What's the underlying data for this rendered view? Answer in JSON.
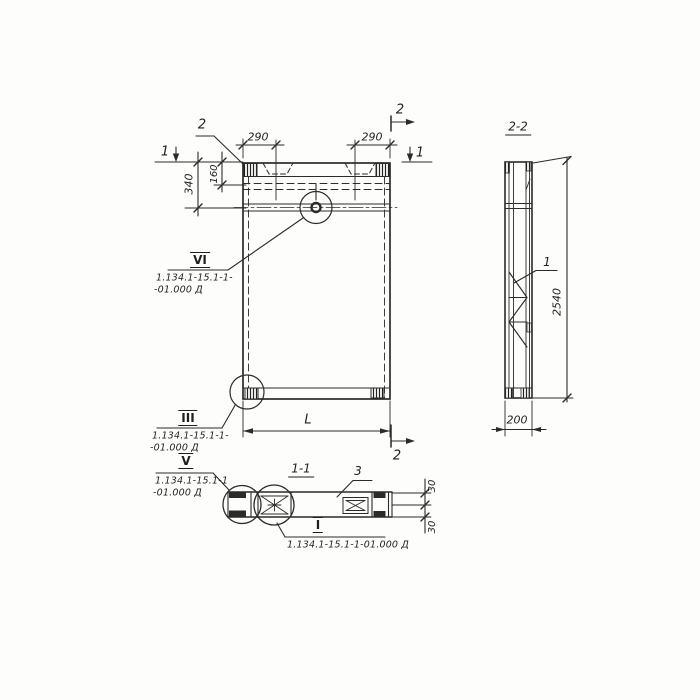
{
  "drawing": {
    "main": {
      "callout2": "2",
      "dim290L": "290",
      "dim290R": "290",
      "dim160": "160",
      "dim340": "340",
      "dimL": "L",
      "sec1L": "1",
      "sec1R": "1",
      "sec2T": "2",
      "sec2B": "2",
      "vi": {
        "num": "VI",
        "l1": "1.134.1-15.1-1-",
        "l2": "-01.000 Д"
      },
      "iii": {
        "num": "III",
        "l1": "1.134.1-15.1-1-",
        "l2": "-01.000 Д"
      }
    },
    "s11": {
      "title": "1-1",
      "item3": "3",
      "dim30t": "30",
      "dim30b": "30",
      "v": {
        "num": "V",
        "l1": "1.134.1-15.1-1",
        "l2": "-01.000 Д"
      },
      "i": {
        "num": "I",
        "l1": "1.134.1-15.1-1-01.000 Д"
      }
    },
    "s22": {
      "title": "2-2",
      "item1": "1",
      "dim2540": "2540",
      "dim200": "200"
    }
  }
}
